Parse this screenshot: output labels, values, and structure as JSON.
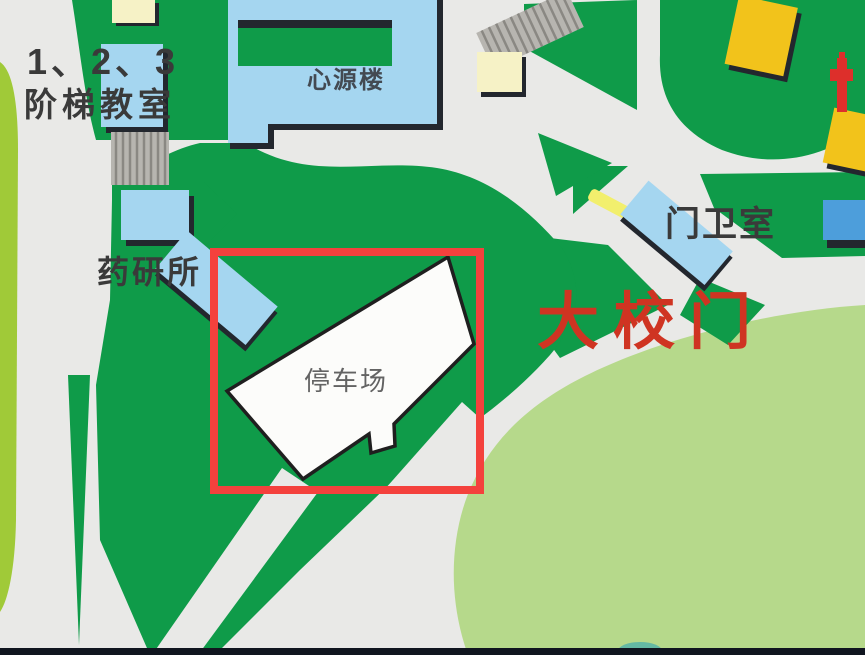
{
  "map": {
    "title": "campus-map",
    "labels": {
      "staircase_classrooms_line1": "1、2、3",
      "staircase_classrooms_line2": "阶梯教室",
      "xinyuan_building": "心源楼",
      "pharmacy_research_institute": "药研所",
      "parking_lot": "停车场",
      "guard_room": "门卫室",
      "main_gate": "大校门"
    },
    "highlight": {
      "shape": "rectangle",
      "color": "#f4413d",
      "target_label": "停车场"
    },
    "colors": {
      "campus_green": "#0f9b49",
      "lawn_green": "#b6d98b",
      "road_gray": "#e9e9e7",
      "building_light_blue": "#a5d6f0",
      "building_medium_blue": "#4d9edb",
      "building_yellow": "#f2c31b",
      "building_cream": "#f6f2c6",
      "parking_white": "#fcfcfa",
      "gate_text_red": "#cf3422",
      "barrier_yellow": "#f2ef6d",
      "olive_strip": "#a0ca38",
      "stairs_gray": "#b7b5b0",
      "hydrant_red": "#dd2f2b",
      "shadow_dark": "#23272e",
      "bottom_bar": "#10151f"
    }
  }
}
